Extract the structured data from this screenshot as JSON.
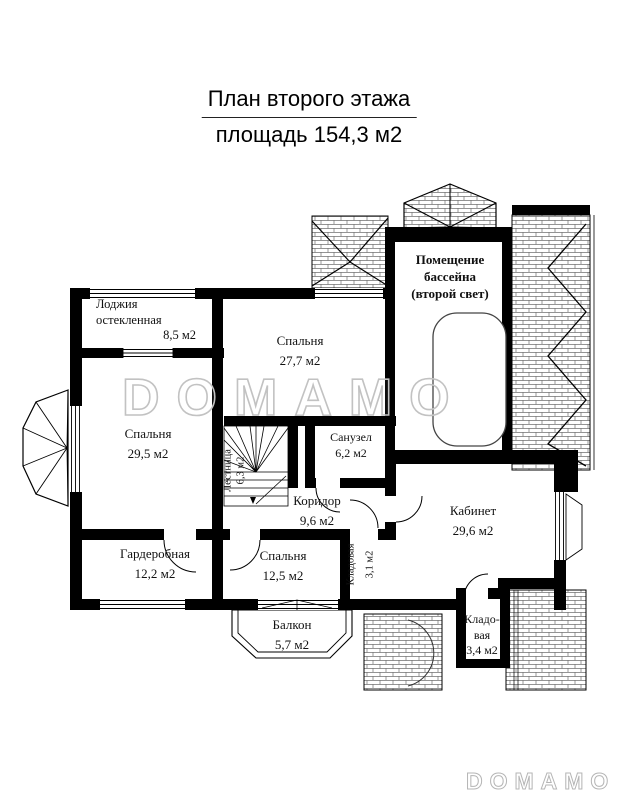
{
  "title": {
    "line1": "План второго этажа",
    "line2": "площадь 154,3 м2"
  },
  "watermark": {
    "center": "DOMAMO",
    "corner": "DOMAMO"
  },
  "colors": {
    "wall": "#000000",
    "watermark_outline": "#c2c2c2",
    "hatch": "#555555"
  },
  "rooms": {
    "loggia": {
      "name": "Лоджия",
      "name2": "остекленная",
      "area": "8,5 м2"
    },
    "bedroom_top": {
      "name": "Спальня",
      "area": "27,7 м2"
    },
    "pool_hall": {
      "line1": "Помещение",
      "line2": "бассейна",
      "line3": "(второй свет)"
    },
    "bedroom_left": {
      "name": "Спальня",
      "area": "29,5 м2"
    },
    "bathroom": {
      "name": "Санузел",
      "area": "6,2 м2"
    },
    "stairs": {
      "name": "Лестница",
      "area": "6,3 м2"
    },
    "corridor": {
      "name": "Коридор",
      "area": "9,6 м2"
    },
    "office": {
      "name": "Кабинет",
      "area": "29,6 м2"
    },
    "wardrobe": {
      "name": "Гардеробная",
      "area": "12,2 м2"
    },
    "bedroom_bottom": {
      "name": "Спальня",
      "area": "12,5 м2"
    },
    "storage_tall": {
      "name": "Кладовая",
      "area": "3,1 м2"
    },
    "balcony": {
      "name": "Балкон",
      "area": "5,7 м2"
    },
    "storage_corner": {
      "name_line1": "Кладо-",
      "name_line2": "вая",
      "area": "3,4 м2"
    }
  }
}
